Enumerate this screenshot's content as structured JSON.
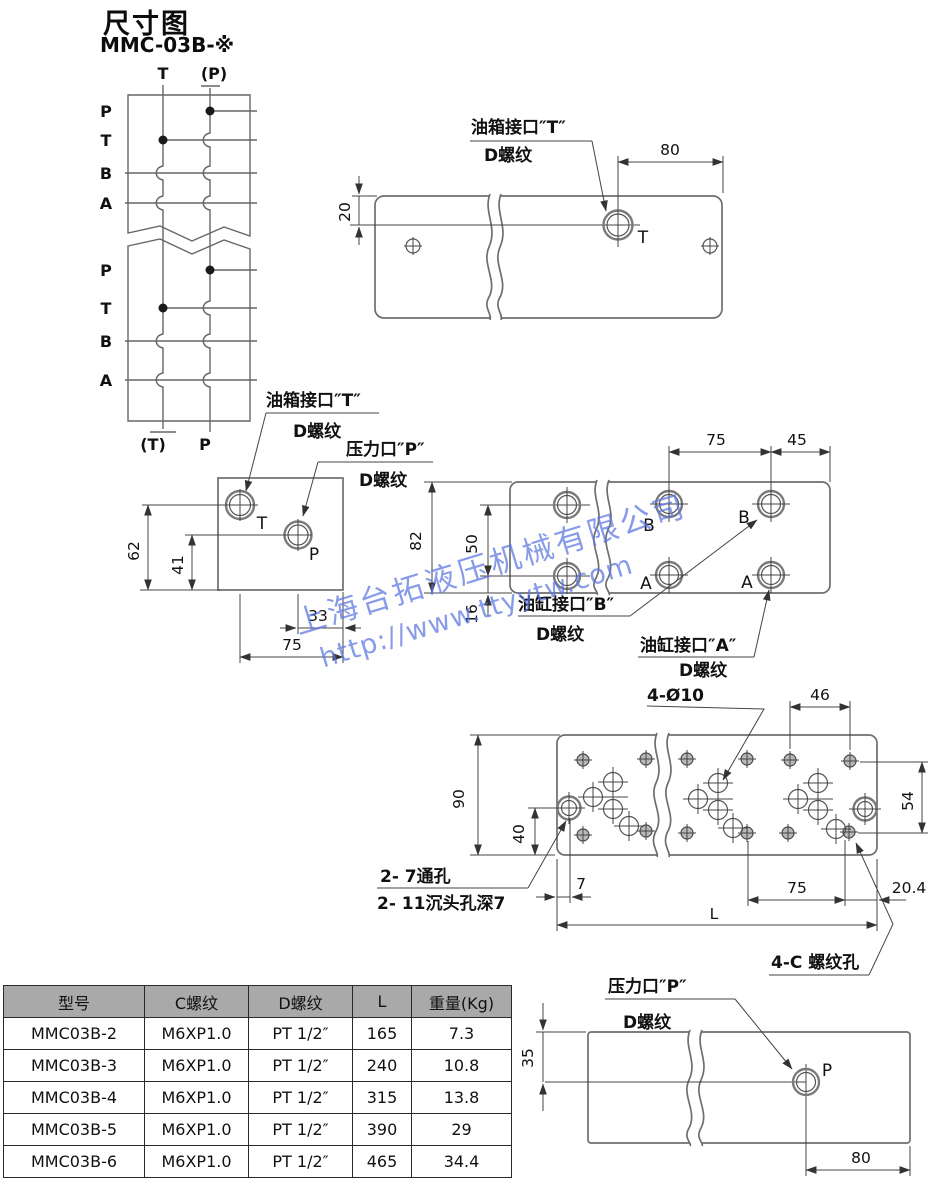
{
  "title": {
    "heading": "尺寸图",
    "model": "MMC-03B-※"
  },
  "watermark": {
    "company": "上海台拓液压机械有限公司",
    "url": "http://www.ttyytw.com",
    "color": "#5b76e0"
  },
  "colors": {
    "drawing_line": "#6e6e6e",
    "dimension_line": "#444444",
    "text": "#111111",
    "table_header_bg": "#a9a9a9",
    "table_border": "#2a2a2a"
  },
  "schematic": {
    "top_t": "T",
    "top_p": "(P)",
    "rows_top": [
      "P",
      "T",
      "B",
      "A"
    ],
    "rows_bottom": [
      "P",
      "T",
      "B",
      "A"
    ],
    "bottom_t": "(T)",
    "bottom_p": "P"
  },
  "top_view": {
    "port_label": "油箱接口″T″",
    "thread_label": "D螺纹",
    "port": "T",
    "dim_width": "80",
    "dim_top": "20"
  },
  "left_view": {
    "tank_label": "油箱接口″T″",
    "tank_thread": "D螺纹",
    "pressure_label": "压力口″P″",
    "pressure_thread": "D螺纹",
    "port_t": "T",
    "port_p": "P",
    "dim_62": "62",
    "dim_41": "41",
    "dim_33": "33",
    "dim_75": "75"
  },
  "right_view": {
    "dim_75": "75",
    "dim_45": "45",
    "dim_82": "82",
    "dim_50": "50",
    "dim_16": "16",
    "port_b_left": "B",
    "port_b_right": "B",
    "port_a_left": "A",
    "port_a_right": "A",
    "cyl_b_label": "油缸接口″B″",
    "cyl_b_thread": "D螺纹",
    "cyl_a_label": "油缸接口″A″",
    "cyl_a_thread": "D螺纹"
  },
  "bottom_view": {
    "holes_label": "4-Ø10",
    "dim_46": "46",
    "dim_90": "90",
    "dim_40": "40",
    "dim_54": "54",
    "dim_7": "7",
    "dim_75": "75",
    "dim_20_4": "20.4",
    "dim_L": "L",
    "through_label": "2- 7通孔",
    "counterbore_label": "2- 11沉头孔深7",
    "thread_label": "4-C 螺纹孔"
  },
  "p_view": {
    "pressure_label": "压力口″P″",
    "thread_label": "D螺纹",
    "port": "P",
    "dim_35": "35",
    "dim_80": "80"
  },
  "table": {
    "headers": [
      "型号",
      "C螺纹",
      "D螺纹",
      "L",
      "重量(Kg)"
    ],
    "rows": [
      [
        "MMC03B-2",
        "M6XP1.0",
        "PT 1/2″",
        "165",
        "7.3"
      ],
      [
        "MMC03B-3",
        "M6XP1.0",
        "PT 1/2″",
        "240",
        "10.8"
      ],
      [
        "MMC03B-4",
        "M6XP1.0",
        "PT 1/2″",
        "315",
        "13.8"
      ],
      [
        "MMC03B-5",
        "M6XP1.0",
        "PT 1/2″",
        "390",
        "29"
      ],
      [
        "MMC03B-6",
        "M6XP1.0",
        "PT 1/2″",
        "465",
        "34.4"
      ]
    ]
  }
}
